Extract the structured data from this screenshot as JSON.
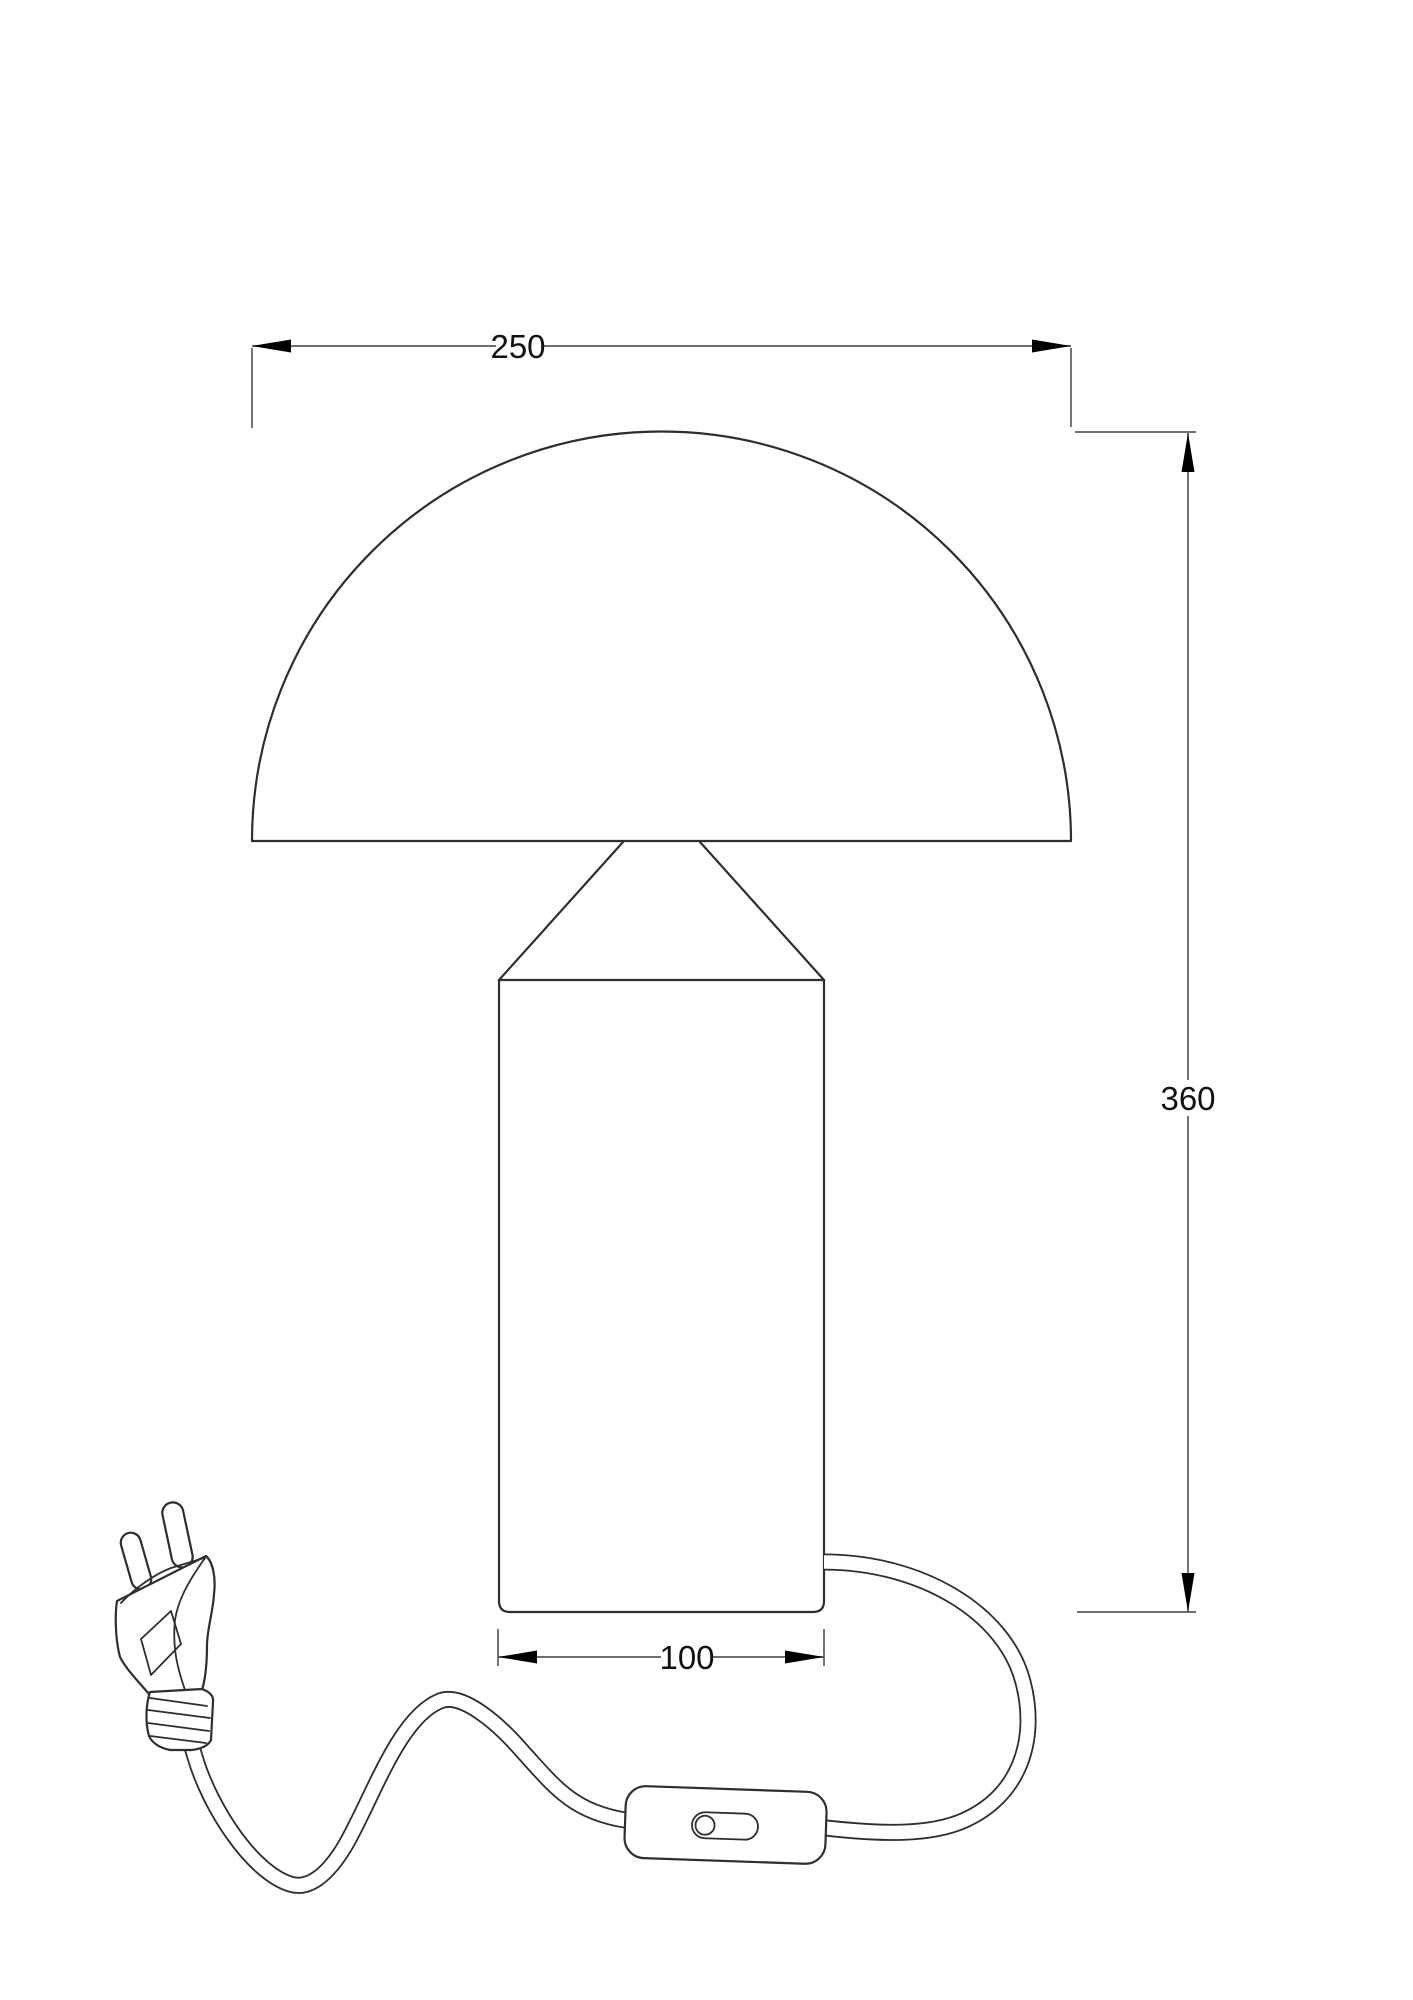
{
  "drawing": {
    "dimensions": {
      "width_top": "250",
      "height_right": "360",
      "base_width": "100"
    },
    "colors": {
      "background": "#ffffff",
      "object_line": "#2e2e2e",
      "dimension_line": "#5b5b5b",
      "text": "#111111"
    }
  }
}
